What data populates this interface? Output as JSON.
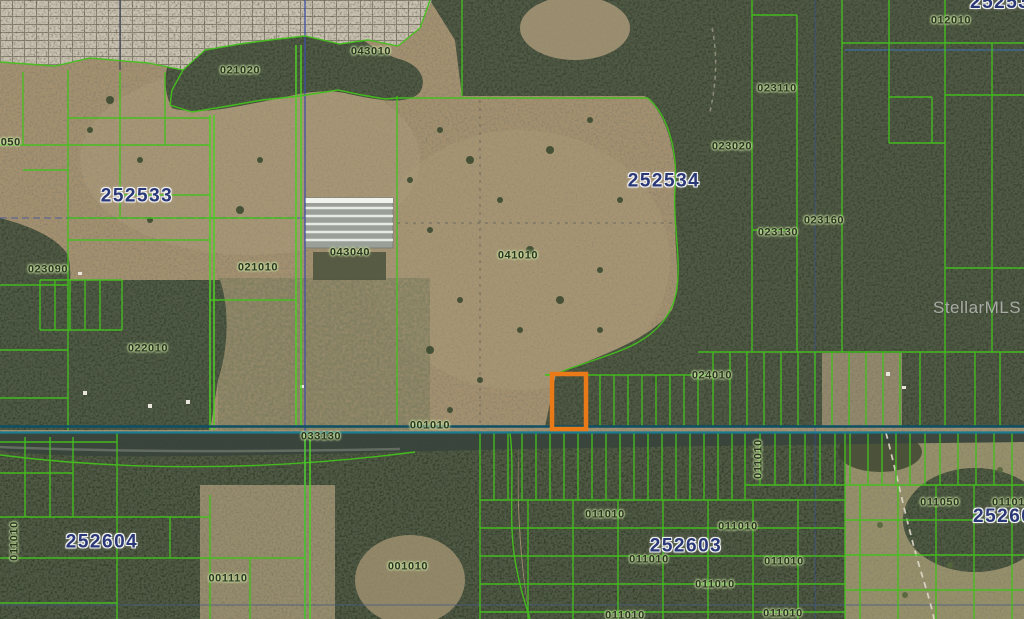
{
  "meta": {
    "description": "Aerial parcel map with highlighted lot",
    "watermark": "StellarMLS"
  },
  "colors": {
    "parcel_line_green": "#44c01d",
    "highlight_orange": "#ea7a18",
    "section_label_blue": "#2b3878",
    "parcel_label_dark": "#2a3520",
    "road_teal": "#1b7a8e",
    "section_line_blue": "#3c50a4",
    "field_tan": "#a49170",
    "forest_green": "#3a4530",
    "platted_pale": "#cac3b3"
  },
  "section_labels": [
    {
      "text": "252533"
    },
    {
      "text": "252534"
    },
    {
      "text": "252604"
    },
    {
      "text": "252603"
    },
    {
      "text": "25253"
    },
    {
      "text": "25260"
    }
  ],
  "parcel_labels": [
    {
      "text": "043010"
    },
    {
      "text": "021020"
    },
    {
      "text": "012010"
    },
    {
      "text": "023110"
    },
    {
      "text": "023020"
    },
    {
      "text": "023160"
    },
    {
      "text": "023130"
    },
    {
      "text": "3050"
    },
    {
      "text": "023090"
    },
    {
      "text": "021010"
    },
    {
      "text": "043040"
    },
    {
      "text": "041010"
    },
    {
      "text": "022010"
    },
    {
      "text": "033130"
    },
    {
      "text": "001010"
    },
    {
      "text": "024010"
    },
    {
      "text": "011010"
    },
    {
      "text": "011050"
    },
    {
      "text": "011010"
    },
    {
      "text": "011010"
    },
    {
      "text": "001110"
    },
    {
      "text": "001010"
    },
    {
      "text": "011010"
    },
    {
      "text": "011010"
    },
    {
      "text": "011010"
    },
    {
      "text": "011010"
    },
    {
      "text": "011010"
    },
    {
      "text": "011010"
    },
    {
      "text": "011010"
    }
  ]
}
